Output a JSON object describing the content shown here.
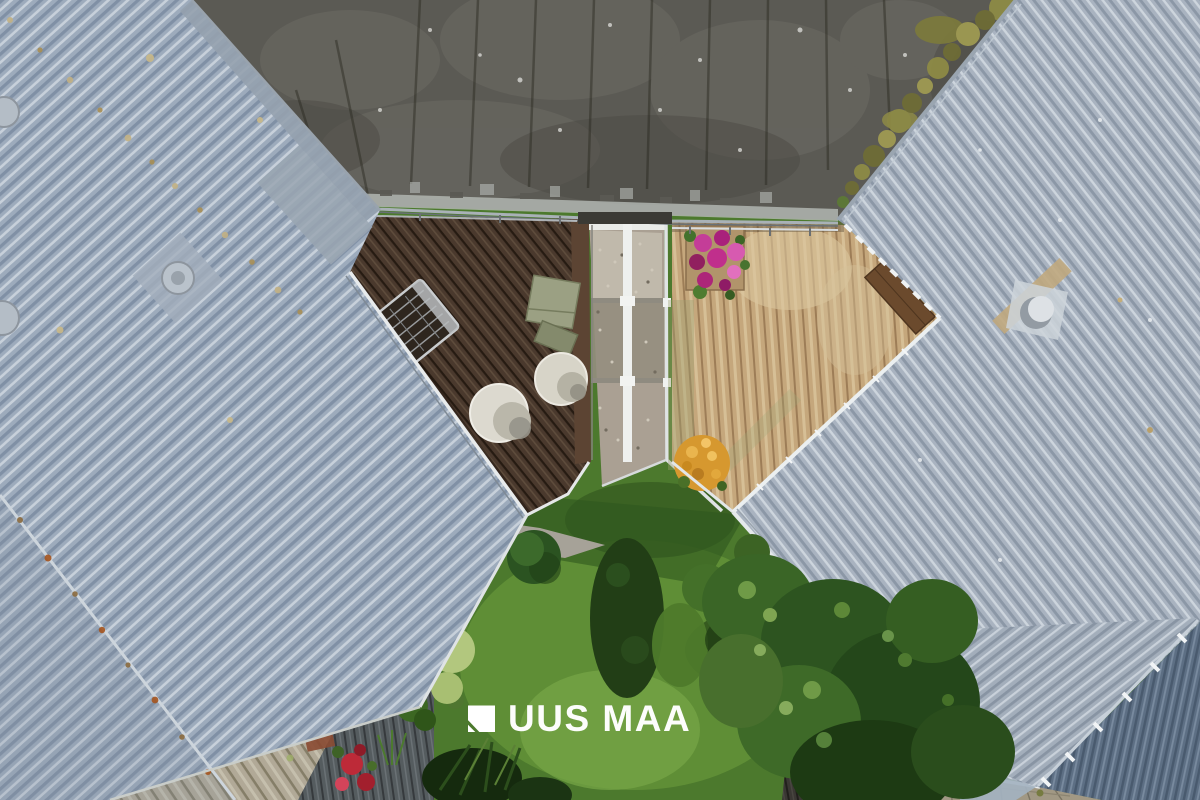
{
  "image": {
    "type": "aerial-drone-photograph",
    "width": 1200,
    "height": 800,
    "alt": "Bird's-eye view of modern terraced houses: light grey corrugated metal roofs on the left and right, a weathered dark flat roof at the top, two wooden roof terraces with outdoor furniture separated by a gravel walkway, and a green courtyard garden with shrubs, a hydrangea bush and trees below"
  },
  "watermark": {
    "text": "UUS MAA",
    "color": "#ffffff",
    "icon": "uus-maa-flag-logo"
  },
  "palette": {
    "left_roof": "#9dabbc",
    "right_roof": "#a9b3c0",
    "flat_roof": "#5b5a54",
    "left_deck": "#4a392d",
    "right_deck": "#c5a77c",
    "lawn": "#4c792d",
    "trees": "#2d5420",
    "gravel": "#aaa093",
    "hydrangea": "#dbe5b8",
    "orange_flowers": "#d6982f",
    "pink_flowers": "#c43d98",
    "red_flowers": "#bd2a38",
    "white_poufs": "#dcd9cf"
  },
  "scene_objects": [
    "dark flat bitumen roof",
    "left corrugated metal roof with round vents",
    "right corrugated metal roof with vent cowl",
    "dark brown terrace deck with lounger, storage box and two white poufs",
    "light wooden terrace deck with pink flower planter and wooden bench",
    "gravel walkway with white metal railing frames",
    "courtyard lawn",
    "clipped round bush",
    "white-green hydrangea bush",
    "tall dark shrub",
    "tree canopy",
    "orange flower bush",
    "red flowers on lower deck",
    "weathered wooden deck strip",
    "old shingle roof corner",
    "plywood board with magenta paint mark"
  ]
}
